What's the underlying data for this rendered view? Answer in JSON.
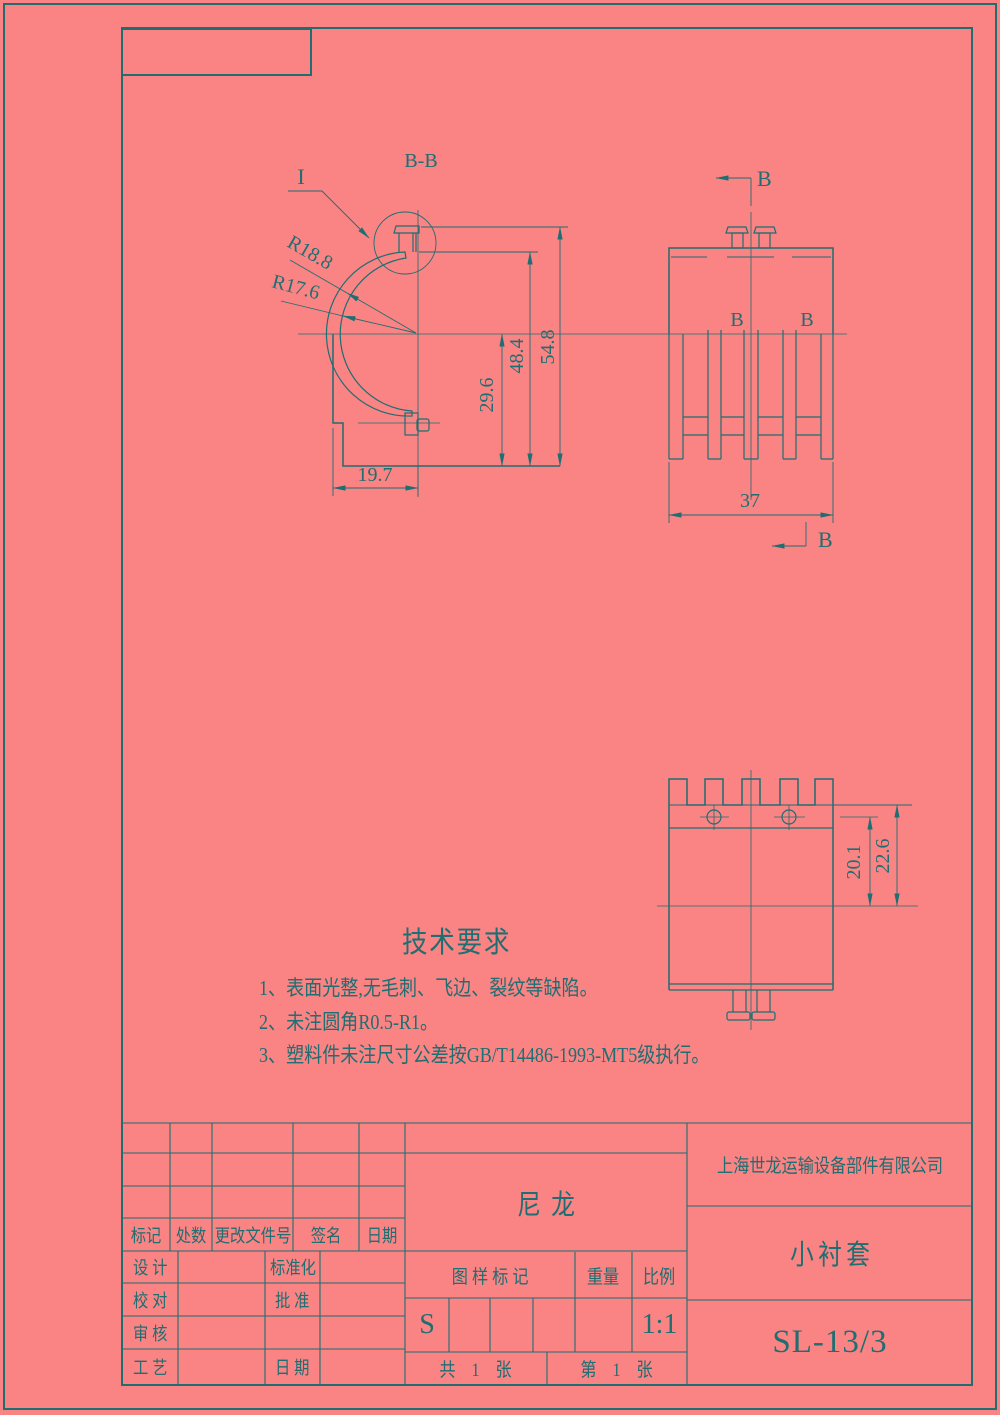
{
  "colors": {
    "background": "#fa8383",
    "line": "#1e6e72"
  },
  "drawing": {
    "section_view_label": "B-B",
    "detail_label": "I",
    "section_letter": "B",
    "dims": {
      "outer_radius": "R18.8",
      "inner_radius": "R17.6",
      "total_height": "54.8",
      "upper_height": "48.4",
      "lower_height": "29.6",
      "base_width": "19.7",
      "overall_width": "37",
      "hole_offset": "20.1",
      "top_depth": "22.6"
    }
  },
  "tech_requirements": {
    "title": "技术要求",
    "items": [
      "1、表面光整,无毛刺、飞边、裂纹等缺陷。",
      "2、未注圆角R0.5-R1。",
      "3、塑料件未注尺寸公差按GB/T14486-1993-MT5级执行。"
    ]
  },
  "title_block": {
    "revision_headers": {
      "mark": "标记",
      "count": "处数",
      "file_no": "更改文件号",
      "signature": "签名",
      "date": "日期"
    },
    "roles": {
      "design": "设 计",
      "standardization": "标准化",
      "proofread": "校 对",
      "approve": "批 准",
      "review": "审 核",
      "process": "工 艺",
      "date": "日 期"
    },
    "material": "尼龙",
    "stamp_label": "图 样 标 记",
    "weight_label": "重量",
    "scale_label": "比例",
    "stamp_value": "S",
    "scale_value": "1:1",
    "sheet_total": "共 1 张",
    "sheet_index": "第 1 张",
    "company": "上海世龙运输设备部件有限公司",
    "part_name": "小衬套",
    "drawing_number": "SL-13/3"
  }
}
